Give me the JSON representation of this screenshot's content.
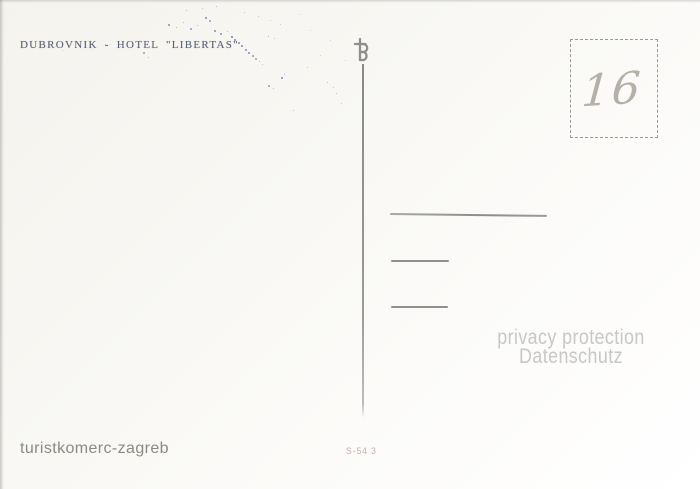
{
  "postcard": {
    "caption": "DUBROVNIK - HOTEL \"LIBERTAS\"",
    "stamp_box_number": "16",
    "publisher": "turistkomerc-zagreb",
    "print_code": "S-54 3",
    "watermark_line1": "privacy protection",
    "watermark_line2": "Datenschutz",
    "colors": {
      "paper_top": "#f5f3ee",
      "paper_bottom": "#ffffff",
      "caption_ink": "#5d6378",
      "divider": "#979797",
      "stamp_border": "#9a9a9a",
      "pencil": "#b5b1a8",
      "publisher_ink": "#8d8984",
      "print_code_ink": "#c2aeaa",
      "watermark": "#c7c7c7",
      "speckle": "#4d5ea6"
    }
  }
}
